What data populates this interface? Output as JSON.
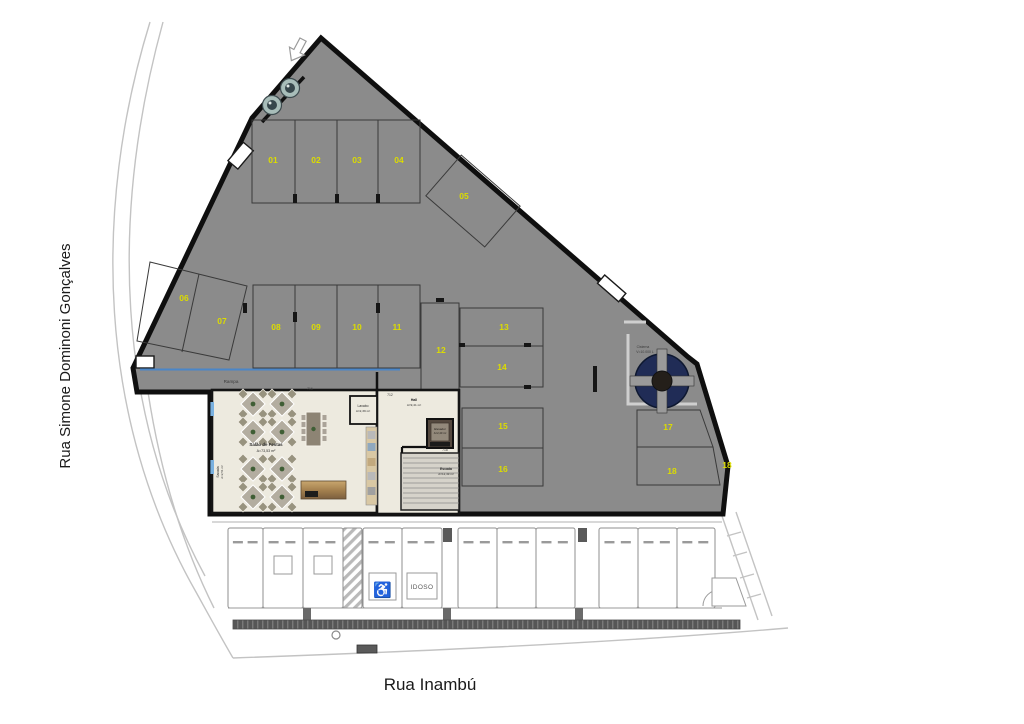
{
  "streets": {
    "left": "Rua Simone Dominoni Gonçalves",
    "bottom": "Rua Inambú"
  },
  "parking": {
    "spots": [
      "01",
      "02",
      "03",
      "04",
      "05",
      "06",
      "07",
      "08",
      "09",
      "10",
      "11",
      "12",
      "13",
      "14",
      "15",
      "16",
      "17",
      "18"
    ],
    "exterior_duplicate": "18"
  },
  "rooms": {
    "salao": {
      "name": "Salão de Festas",
      "area": "A=73,53 m²"
    },
    "lavabo": {
      "name": "Lavabo",
      "area": "A=2,39 m²"
    },
    "hall": {
      "name": "Hall",
      "area": "A=9,41 m²"
    },
    "elevador": {
      "name": "Elevador",
      "area": "A=2,40 m²"
    },
    "escada": {
      "name": "Escada",
      "area": "A=12,49 m²"
    },
    "sacada": {
      "name": "Sacada",
      "area": "A=2,51 m²"
    },
    "cisterna": {
      "name": "Cisterna",
      "note": "V=10.000 L"
    },
    "rampa": {
      "name": "Rampa"
    }
  },
  "levels": [
    "716",
    "712",
    "718"
  ],
  "garage": {
    "accessible_icon": "♿",
    "idoso_label": "IDOSO",
    "spaces": [
      {
        "type": "plain"
      },
      {
        "type": "plain",
        "square": true
      },
      {
        "type": "plain",
        "square": true
      },
      {
        "type": "hatch"
      },
      {
        "type": "accessible"
      },
      {
        "type": "idoso"
      },
      {
        "type": "plain"
      },
      {
        "type": "plain"
      },
      {
        "type": "plain"
      },
      {
        "type": "plain"
      },
      {
        "type": "plain"
      },
      {
        "type": "plain"
      }
    ]
  },
  "colors": {
    "lot_fill": "#8b8b8b",
    "spot_number": "#dcdc00",
    "cistern_fill": "#202c56",
    "window_accent": "#7ab1e0",
    "ramp_line": "#4a86c8",
    "wood_light": "#c9a76e",
    "wood_dark": "#7c5f3e"
  }
}
